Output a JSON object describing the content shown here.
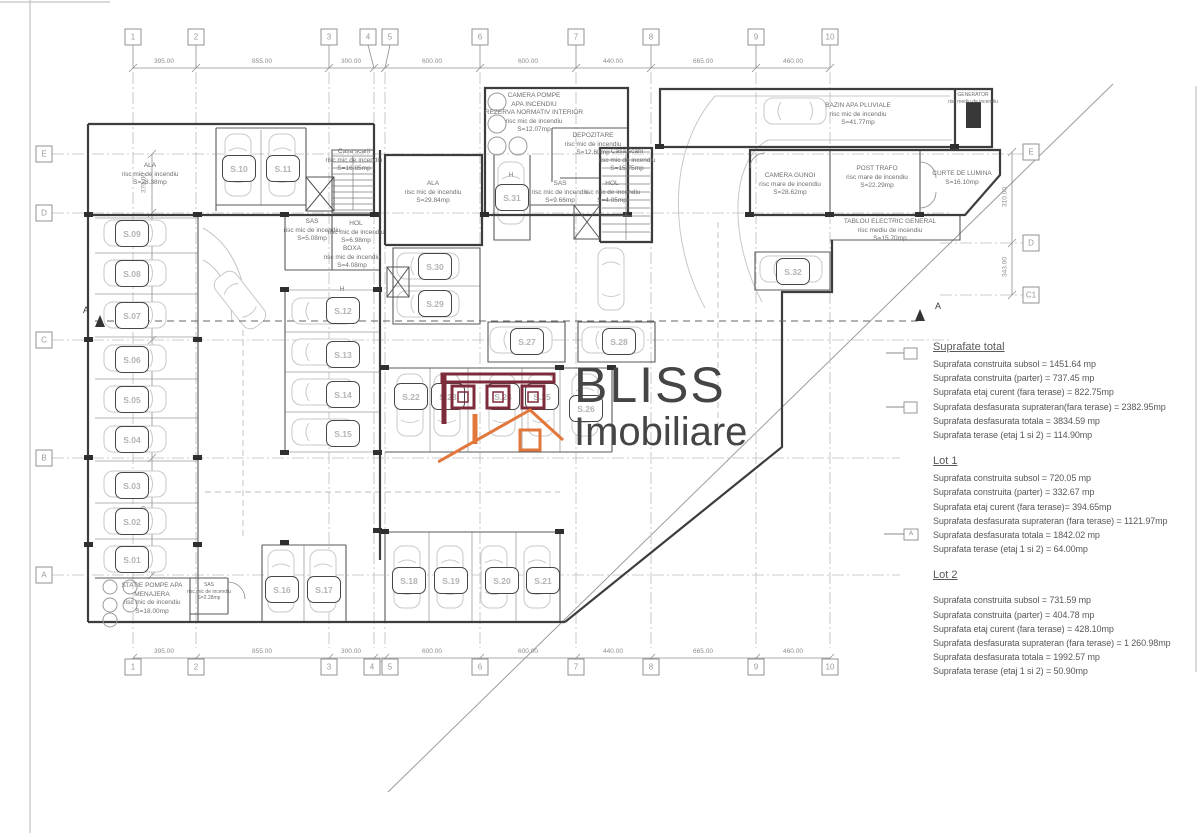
{
  "logo": {
    "name": "BLISS",
    "subtitle": "Imobiliare"
  },
  "markers": {
    "section": "A"
  },
  "grid": {
    "top": [
      "1",
      "2",
      "3",
      "4",
      "5",
      "6",
      "7",
      "8",
      "9",
      "10"
    ],
    "left": [
      "E",
      "D",
      "C",
      "B",
      "A"
    ],
    "right": [
      "E",
      "D",
      "C1"
    ]
  },
  "dims": {
    "top": [
      "395.00",
      "855.00",
      "300.00",
      "600.00",
      "600.00",
      "440.00",
      "665.00",
      "460.00"
    ],
    "bottom": [
      "395.00",
      "855.00",
      "300.00",
      "600.00",
      "600.00",
      "440.00",
      "665.00",
      "460.00"
    ],
    "left": [
      "370.00",
      "770.00",
      "770.00",
      "770.00"
    ],
    "right": [
      "310.00",
      "343.00"
    ]
  },
  "spots": {
    "handicap": "H",
    "s01": "S.01",
    "s02": "S.02",
    "s03": "S.03",
    "s04": "S.04",
    "s05": "S.05",
    "s06": "S.06",
    "s07": "S.07",
    "s08": "S.08",
    "s09": "S.09",
    "s10": "S.10",
    "s11": "S.11",
    "s12": "S.12",
    "s13": "S.13",
    "s14": "S.14",
    "s15": "S.15",
    "s16": "S.16",
    "s17": "S.17",
    "s18": "S.18",
    "s19": "S.19",
    "s20": "S.20",
    "s21": "S.21",
    "s22": "S.22",
    "s23": "S.23",
    "s24": "S.24",
    "s25": "S.25",
    "s26": "S.26",
    "s27": "S.27",
    "s28": "S.28",
    "s29": "S.29",
    "s30": "S.30",
    "s31": "S.31",
    "s32": "S.32"
  },
  "rooms": {
    "ala_left": "ALA\nrisc mic de incendiu\nS=28.38mp",
    "ala_center": "ALA\nrisc mic de incendiu\nS=29.84mp",
    "camera_pompe": "CAMERA POMPE\nAPA INCENDIU\nREZERVA NORMATIV INTERIOR\nrisc mic de incendiu\nS=12.07mp",
    "depozitare": "DEPOZITARE\nrisc mic de incendiu\nS=12.60mp",
    "bazin": "BAZIN APA PLUVIALE\nrisc mic de incendiu\nS=41.77mp",
    "generator": "GENERATOR\nrisc mediu de incendiu",
    "camera_gunoi": "CAMERA GUNOI\nrisc mare de incendiu\nS=28.62mp",
    "post_trafo": "POST TRAFO\nrisc mare de incendiu\nS=22.29mp",
    "curte_lumina": "CURTE DE LUMINA\nS=16.10mp",
    "tablou": "TABLOU ELECTRIC GENERAL\nrisc mediu de incendiu\nS=15.70mp",
    "casa_scarii_1": "Casa scarii\nrisc mic de incendiu\nS=16.85mp",
    "casa_scarii_2": "Casa scarii\nrisc mic de incendiu\nS=15.75mp",
    "sas_1": "SAS\nrisc mic de incendiu\nS=5.08mp",
    "hol_1": "HOL\nrisc mic de incendiu\nS=6.98mp",
    "boxa": "BOXA\nrisc mic de incendiu\nS=4.08mp",
    "sas_2": "SAS\nrisc mic de incendiu\nS=9.66mp",
    "hol_2": "HOL\nrisc mic de incendiu\nS=4.05mp",
    "statie_pompe": "STATIE POMPE APA\nMENAJERA\nrisc mic de incendiu\nS=18.00mp",
    "sas_3": "SAS\nrisc mic de incendiu\nS=2.28mp"
  },
  "areas": {
    "total": {
      "heading": "Suprafate total",
      "body": "Suprafata construita subsol = 1451.64 mp\nSuprafata construita (parter) = 737.45 mp\nSuprafata etaj curent (fara terase) = 822.75mp\nSuprafata desfasurata suprateran(fara terase) = 2382.95mp\nSuprafata desfasurata totala = 3834.59 mp\nSuprafata terase (etaj 1 si 2) = 114.90mp"
    },
    "lot1": {
      "heading": "Lot 1",
      "body": "Suprafata construita subsol = 720.05 mp\nSuprafata construita (parter) = 332.67 mp\nSuprafata etaj curent (fara terase)= 394.65mp\nSuprafata desfasurata suprateran (fara terase) = 1121.97mp\nSuprafata desfasurata totala = 1842.02 mp\nSuprafata terase (etaj 1 si 2) = 64.00mp"
    },
    "lot2": {
      "heading": "Lot 2",
      "body": "Suprafata construita subsol = 731.59 mp\nSuprafata construita (parter) = 404.78 mp\nSuprafata etaj curent (fara terase) = 428.10mp\nSuprafata desfasurata suprateran (fara terase) = 1 260.98mp\nSuprafata desfasurata totala = 1992.57 mp\nSuprafata terase (etaj 1 si 2) = 50.90mp"
    }
  }
}
